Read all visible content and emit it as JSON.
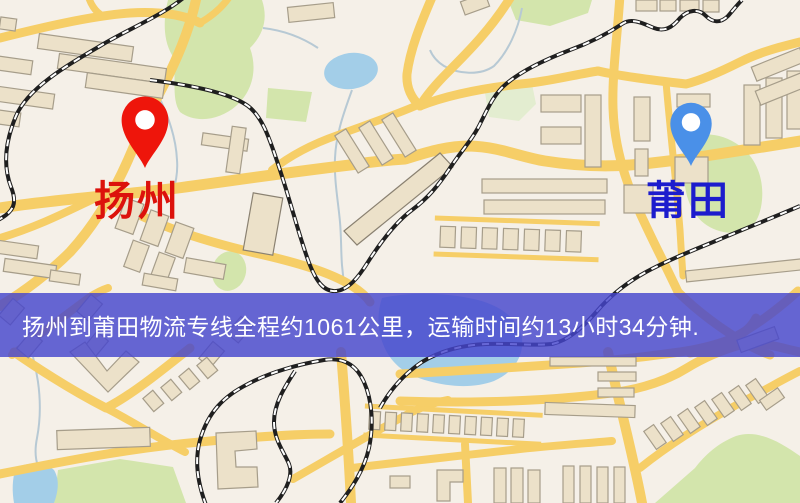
{
  "map": {
    "origin_marker": {
      "label": "扬州",
      "pin_color": "#ee150b",
      "pin_hole_color": "#ffffff",
      "label_color": "#dc120c"
    },
    "destination_marker": {
      "label": "莆田",
      "pin_color": "#4a90e8",
      "pin_hole_color": "#ffffff",
      "label_color": "#1c1ccd"
    },
    "banner": {
      "text": "扬州到莆田物流专线全程约1061公里，运输时间约13小时34分钟.",
      "distance_km": "1061",
      "duration": "13小时34分钟",
      "background_color": "#4646cd",
      "text_color": "#ffffff"
    },
    "palette": {
      "map_background": "#f5f0e8",
      "road": "#f6ce67",
      "building_fill": "#ece1c9",
      "building_outline": "#a69d8a",
      "park": "#d3e5ac",
      "park_pale": "#e3edd0",
      "water": "#a3cee8",
      "stream": "#b7c9d4",
      "railway": "#1f1f1f"
    }
  }
}
